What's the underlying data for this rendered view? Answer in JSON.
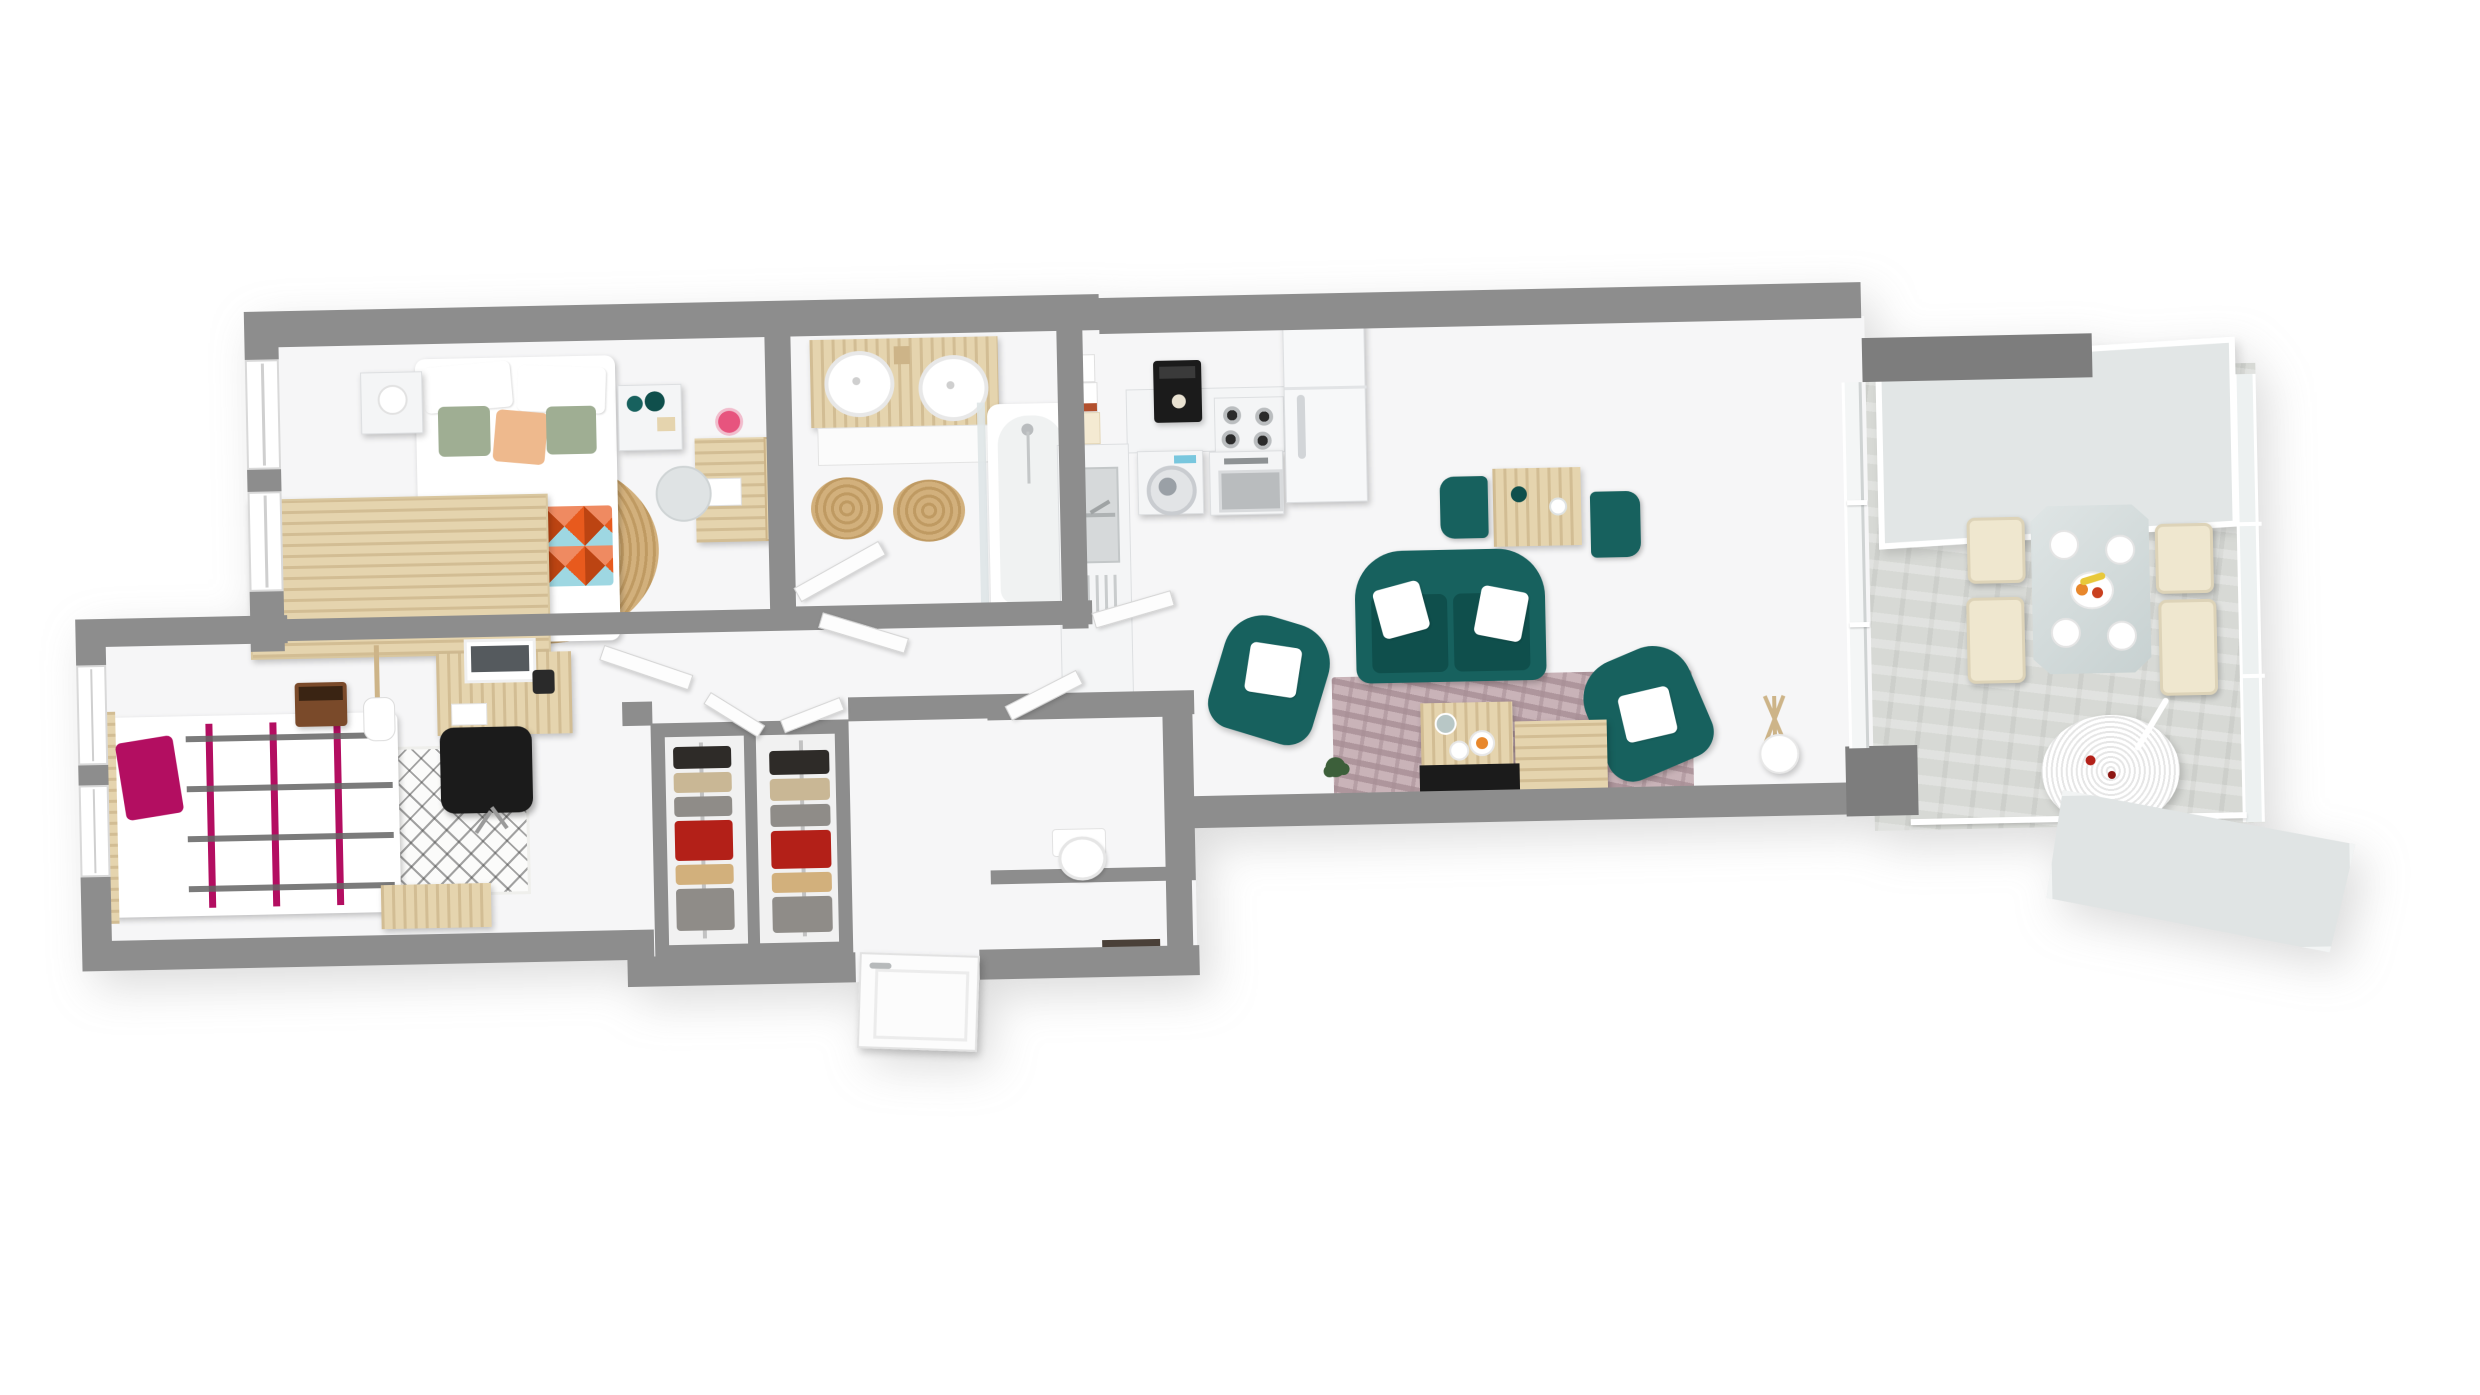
{
  "scene": {
    "type": "3d-rendered-floor-plan",
    "view": "top-down axonometric",
    "background": "#ffffff",
    "text_on_image": "none"
  },
  "colors": {
    "wall": "#8d8d8d",
    "wall_dark": "#7d7d7d",
    "floor": "#f6f6f7",
    "sunroom_floor": "#d7d9d5",
    "glass": "#e2e6e6",
    "glass_light": "#edf1f1",
    "wood": "#e5d4ae",
    "wood_dark": "#cdb488",
    "teal": "#17615e",
    "teal_dark": "#0f4f4c",
    "sage": "#9fae93",
    "peach": "#eeb98d",
    "orange": "#e85a1d",
    "orange_dark": "#bc4412",
    "sky": "#9ed7e2",
    "salmon": "#ef8a61",
    "jute": "#d2b07c",
    "jute_dark": "#bf9a62",
    "magenta": "#b30e61",
    "mauve": "#c9b3b8",
    "mauve_dark": "#a78e95",
    "cream": "#efe7cf",
    "black": "#1b1b1b",
    "brown_amp": "#7a4a2a",
    "display_blue": "#79c7de",
    "fruit_orange": "#e8872b",
    "fruit_yellow": "#e8c83a",
    "leaf_green": "#3c5f3a",
    "cloth_dark": "#2e2b28",
    "cloth_beige": "#c9b795",
    "cloth_red": "#b32018",
    "cloth_gray": "#8f8c88",
    "mat_dark": "#4a4038"
  },
  "rooms": [
    {
      "id": "master-bedroom",
      "name": "Master bedroom",
      "furniture": [
        "double bed",
        "triangle-pattern throw",
        "white pillows",
        "sage pillow",
        "peach pillow",
        "nightstand x2",
        "table lamp",
        "teal vases",
        "round jute rug",
        "wood wardrobe",
        "desk",
        "chair",
        "pink orchid"
      ]
    },
    {
      "id": "bathroom",
      "name": "Bathroom",
      "furniture": [
        "double vanity",
        "vessel sink x2",
        "jute rug x2",
        "towel ladder",
        "bathtub with shower",
        "glass screen"
      ]
    },
    {
      "id": "bedroom-2",
      "name": "Bedroom 2",
      "furniture": [
        "single bed",
        "magenta pillow",
        "berber rug",
        "desk",
        "monitor",
        "office chair",
        "guitar amp",
        "electric guitar",
        "storage bench"
      ]
    },
    {
      "id": "walk-in-closet",
      "name": "Walk-in closet",
      "furniture": [
        "hanging rail x2",
        "clothes on hangers"
      ]
    },
    {
      "id": "wc",
      "name": "WC",
      "furniture": [
        "toilet"
      ]
    },
    {
      "id": "entry",
      "name": "Entry",
      "furniture": [
        "front door",
        "doormat"
      ]
    },
    {
      "id": "kitchen",
      "name": "Kitchen",
      "furniture": [
        "double sink unit",
        "dish rack",
        "storage boxes",
        "washing machine",
        "oven",
        "gas hob 4 burners",
        "coffee machine",
        "fridge"
      ]
    },
    {
      "id": "living-room",
      "name": "Living room",
      "furniture": [
        "teal loveseat",
        "teal armchair x2",
        "white cushions",
        "nesting coffee tables",
        "breakfast table with 2 teal chairs",
        "mottled rug",
        "tv bench",
        "tripod floor lamp",
        "plant"
      ]
    },
    {
      "id": "sunroom",
      "name": "Sunroom dining",
      "furniture": [
        "glass dining table",
        "cream dining chair x4",
        "place settings",
        "fruit bowl",
        "hanging egg chair",
        "glass roof panel",
        "glass walls",
        "railing"
      ]
    },
    {
      "id": "hallway",
      "name": "Hallway",
      "furniture": [
        "interior doors"
      ]
    }
  ]
}
